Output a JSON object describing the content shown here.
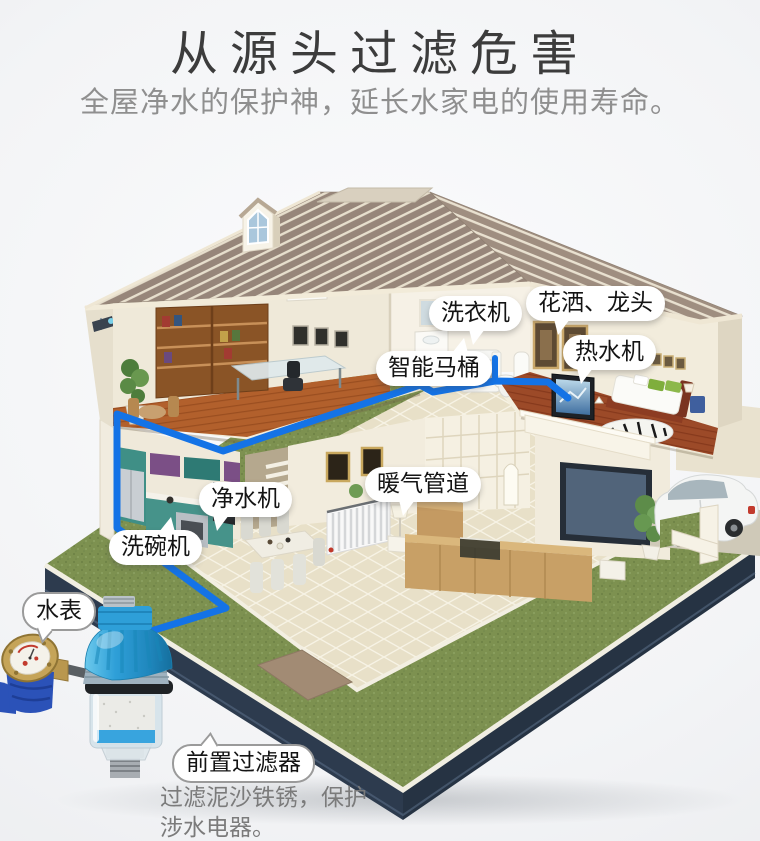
{
  "header": {
    "title": "从源头过滤危害",
    "subtitle": "全屋净水的保护神，延长水家电的使用寿命。"
  },
  "callouts": {
    "washing_machine": "洗衣机",
    "shower_faucet": "花洒、龙头",
    "water_heater": "热水机",
    "smart_toilet": "智能马桶",
    "water_purifier": "净水机",
    "heating_pipes": "暖气管道",
    "dishwasher": "洗碗机",
    "water_meter": "水表",
    "pre_filter": "前置过滤器"
  },
  "description": {
    "line1": "过滤泥沙铁锈，保护",
    "line2": "涉水电器。"
  },
  "colors": {
    "pipe_blue": "#1473e6",
    "lawn_green": "#7d9150",
    "base_navy": "#2d3b4e",
    "roof_tan": "#97867a",
    "filter_blue": "#2e9fd8",
    "label_text": "#141414"
  }
}
